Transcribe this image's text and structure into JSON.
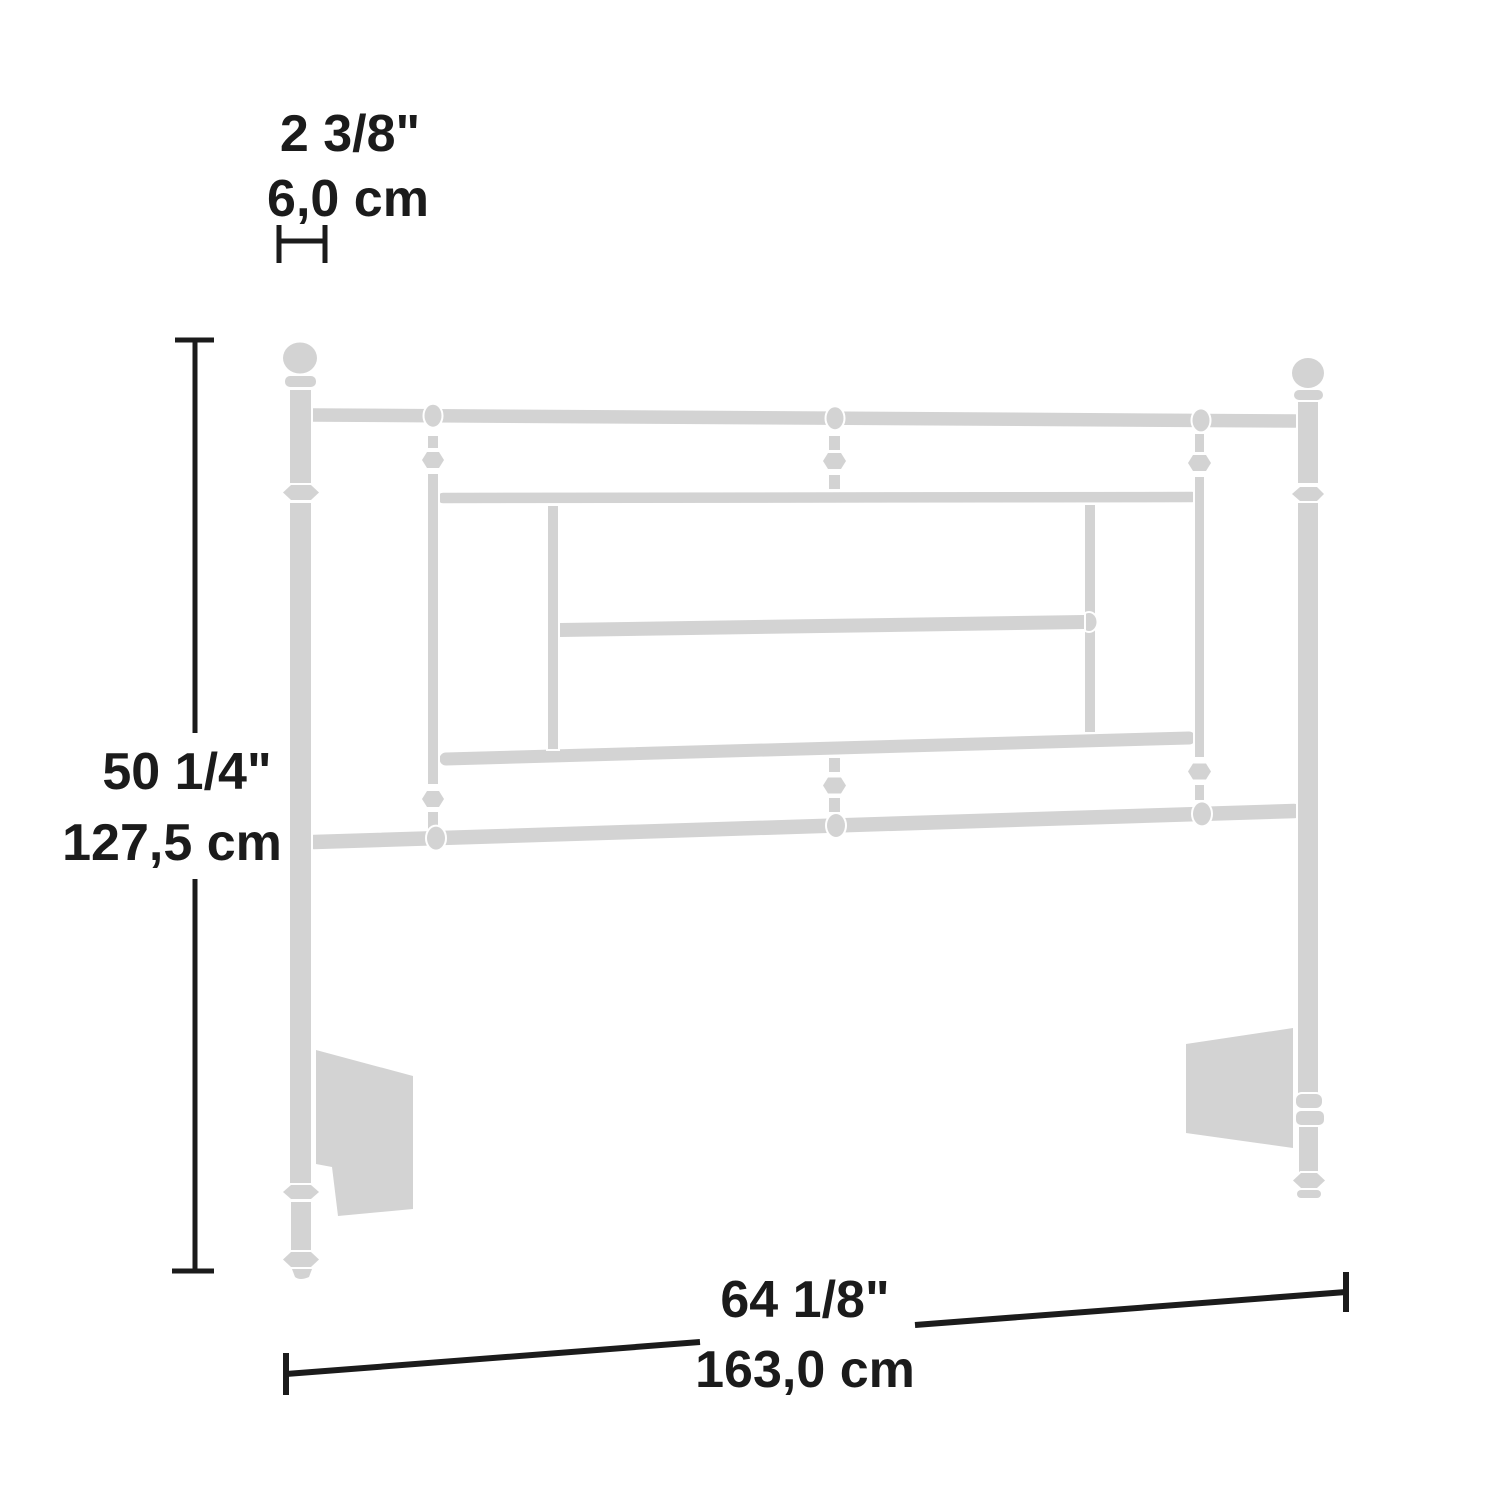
{
  "diagram": {
    "dimensions": {
      "post_width": {
        "inches": "2 3/8\"",
        "cm": "6,0 cm"
      },
      "height": {
        "inches": "50 1/4\"",
        "cm": "127,5 cm"
      },
      "width": {
        "inches": "64 1/8\"",
        "cm": "163,0 cm"
      }
    }
  },
  "colors": {
    "figure": "#d3d3d3",
    "dimension": "#1b1b1b",
    "background": "#ffffff"
  }
}
